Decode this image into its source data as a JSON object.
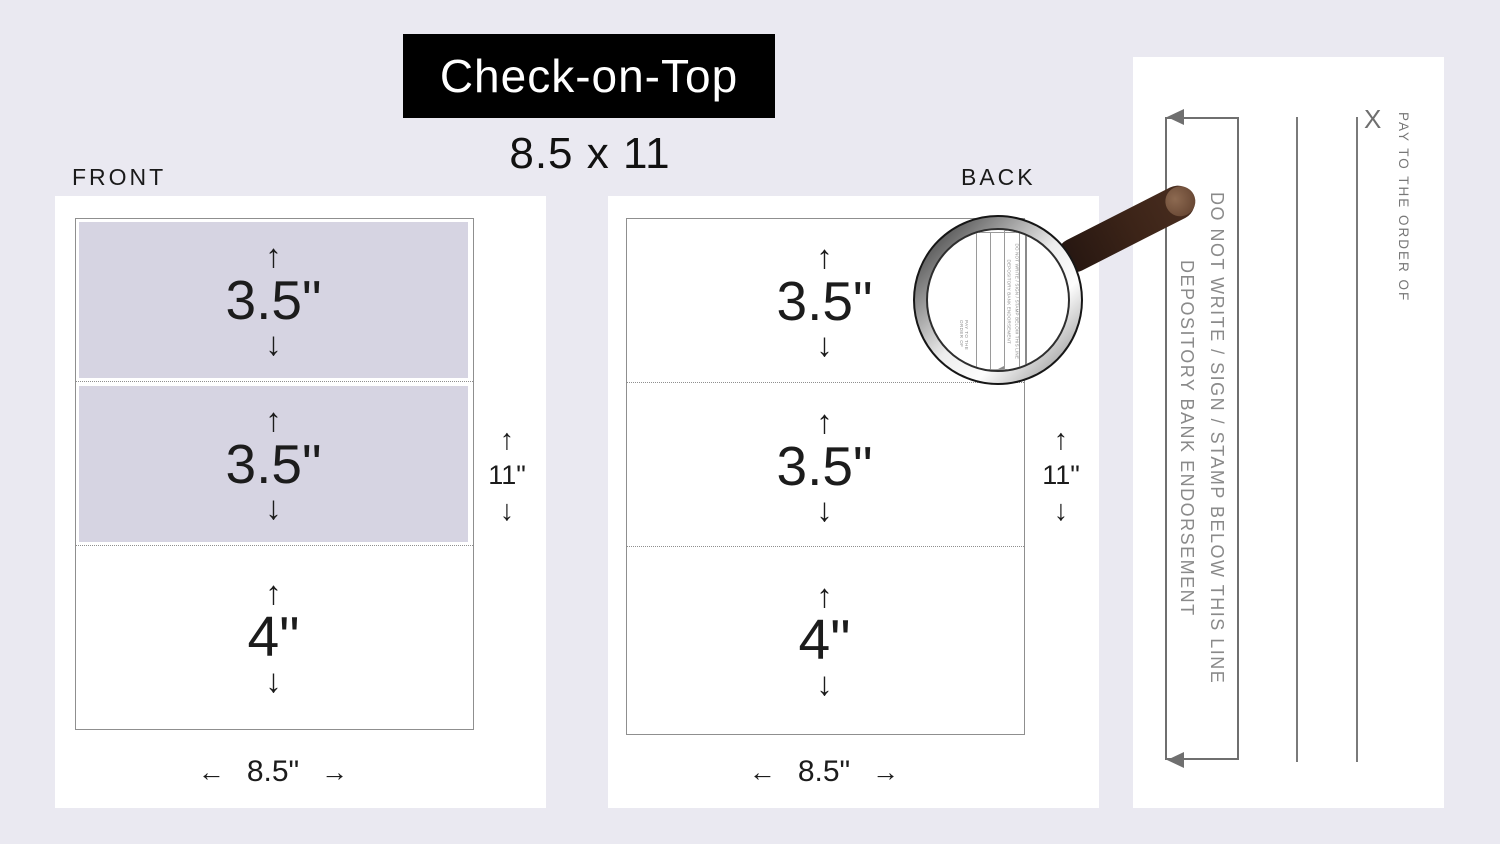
{
  "page": {
    "title": "Check-on-Top",
    "size_label": "8.5 x 11"
  },
  "front": {
    "label": "FRONT",
    "sections": [
      {
        "label": "3.5\"",
        "shaded": true
      },
      {
        "label": "3.5\"",
        "shaded": true
      },
      {
        "label": "4\"",
        "shaded": false
      }
    ],
    "height_label": "11\"",
    "width_label": "8.5\""
  },
  "back": {
    "label": "BACK",
    "sections": [
      {
        "label": "3.5\"",
        "shaded": false
      },
      {
        "label": "3.5\"",
        "shaded": false
      },
      {
        "label": "4\"",
        "shaded": false
      }
    ],
    "height_label": "11\"",
    "width_label": "8.5\""
  },
  "detail_panel": {
    "do_not_write_line": "DO NOT WRITE / SIGN / STAMP BELOW THIS LINE",
    "endorsement_line": "DEPOSITORY BANK ENDORSEMENT",
    "x_mark": "X",
    "pay_to_label": "PAY TO THE ORDER OF"
  },
  "magnifier": {
    "mini_do_not_write": "DO NOT WRITE / SIGN / STAMP BELOW THIS LINE",
    "mini_endorsement": "DEPOSITORY BANK ENDORSEMENT",
    "mini_pay_to": "PAY TO THE ORDER OF"
  },
  "icons": {
    "up": "↑",
    "down": "↓",
    "left": "←",
    "right": "→"
  },
  "colors": {
    "background": "#eae9f1",
    "panel_shade": "#d6d4e2",
    "title_bg": "#000000",
    "title_text": "#ffffff",
    "sheet_border": "#8f8f8f",
    "detail_gray": "#8a8a8a",
    "handle_brown": "#3c2418",
    "text_dark": "#1c1c1c"
  }
}
